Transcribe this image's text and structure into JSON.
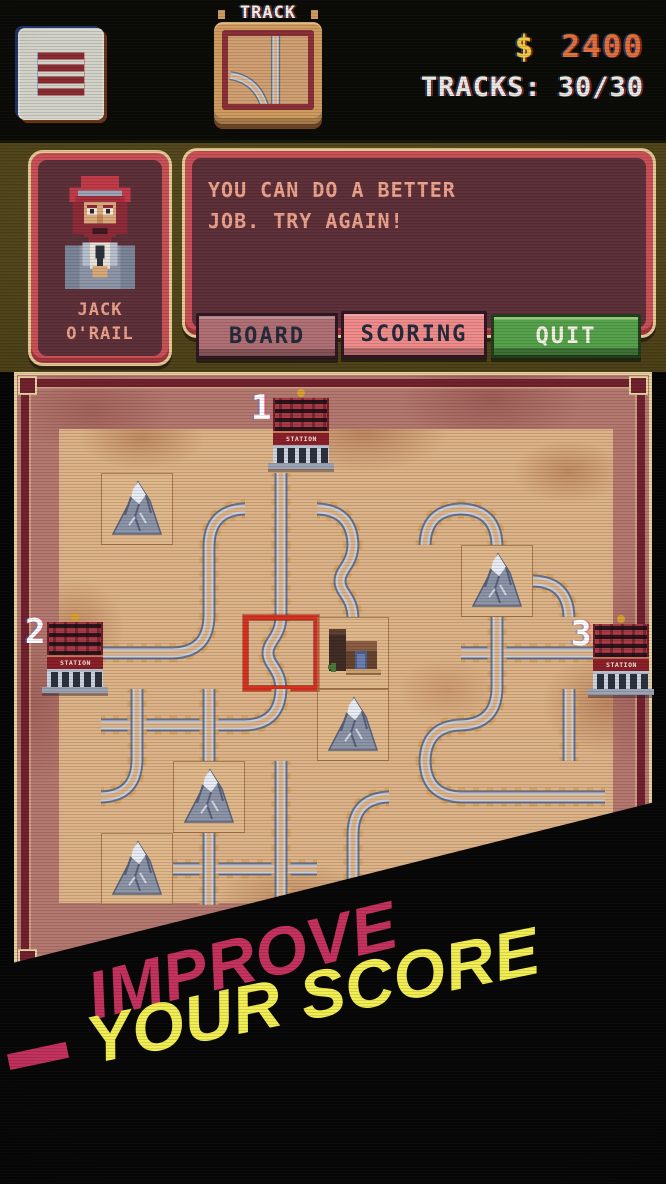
{
  "hud": {
    "track_panel_label": "TRACK",
    "money_symbol": "$",
    "money_value": "2400",
    "money_symbol_color": "#edc93c",
    "money_value_color": "#e2703a",
    "tracks_label": "TRACKS:",
    "tracks_value": "30/30"
  },
  "dialog": {
    "portrait_name_line1": "JACK",
    "portrait_name_line2": "O'RAIL",
    "speech_line1": "YOU CAN DO A BETTER",
    "speech_line2": "JOB. TRY AGAIN!",
    "buttons": [
      {
        "label": "BOARD"
      },
      {
        "label": "SCORING"
      },
      {
        "label": "QUIT"
      }
    ]
  },
  "board": {
    "stations": [
      {
        "number": "1",
        "label": "STATION"
      },
      {
        "number": "2",
        "label": "STATION"
      },
      {
        "number": "3",
        "label": "STATION"
      }
    ],
    "tiles": [
      [
        "mtn",
        "c-se",
        "v",
        "c-sw",
        "c-se",
        "c-sw",
        ""
      ],
      [
        "",
        "v",
        "v",
        "s",
        "",
        "mtn",
        "c-sw"
      ],
      [
        "h",
        "c-nw",
        "s",
        "house",
        "",
        "x",
        "h"
      ],
      [
        "x",
        "x",
        "c-nw",
        "mtn",
        "c-se",
        "c-nw",
        "v"
      ],
      [
        "c-nw",
        "mtn",
        "v",
        "c-se",
        "c-ne",
        "h",
        "h"
      ],
      [
        "mtn",
        "x",
        "x",
        "v",
        "c-se",
        "c-sw",
        ""
      ]
    ],
    "highlight": {
      "row": 2,
      "col": 2
    }
  },
  "banner": {
    "line1": "IMPROVE",
    "line2": "YOUR SCORE",
    "line1_color": "#c5315e",
    "line2_color": "#f2ee52"
  },
  "colors": {
    "panel_border": "#c94f56",
    "panel_interior": "#5d3039",
    "speech_text": "#eca28b",
    "quit_green": "#55a04a",
    "board_frame": "#71212d",
    "board_margin": "#b3776e",
    "sand": "#dcb286",
    "highlight_red": "#d8301f"
  }
}
